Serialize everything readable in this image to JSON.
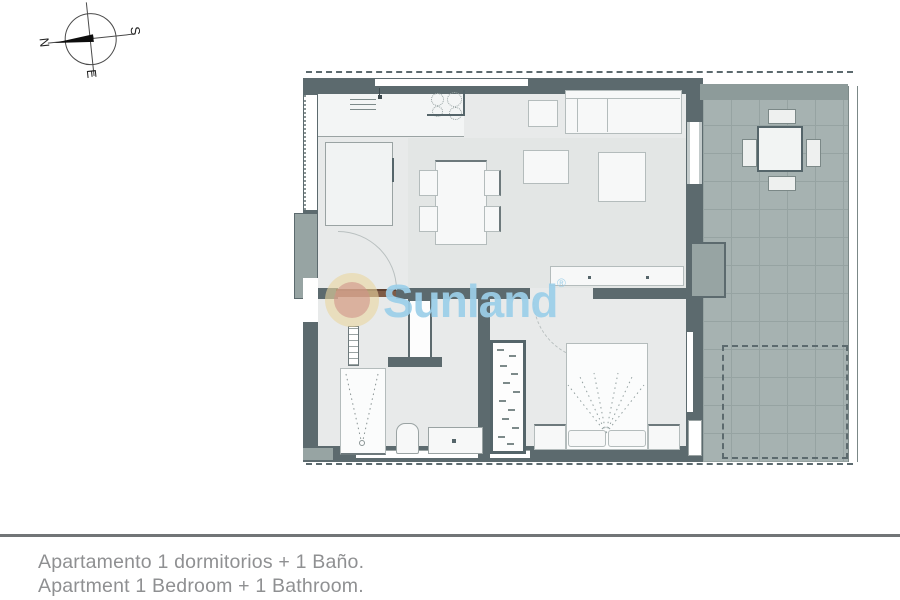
{
  "compass": {
    "north": "N",
    "south": "S",
    "east": "E"
  },
  "watermark": {
    "brand": "Sunland",
    "registered_mark": "®"
  },
  "caption": {
    "spanish": "Apartamento 1 dormitorios + 1 Baño.",
    "english": "Apartment 1 Bedroom + 1 Bathroom."
  },
  "plan_items": [
    "kitchen",
    "living-dining-room",
    "bathroom",
    "bedroom",
    "terrace"
  ],
  "colors": {
    "wall": "#5c6a6e",
    "wall-light": "#97a4a3",
    "floor": "#e8eaea",
    "floor-shade": "#e3e6e5",
    "terrace": "#a6b2b1",
    "terrace-line": "#96a3a2",
    "furn": "#f7f8f8",
    "furn-border": "#b4bcbc",
    "line-dark": "#6d797c",
    "accent-blue": "#9ccfe9",
    "sun-outer": "rgba(233,213,158,0.60)",
    "sun-inner": "rgba(209,146,136,0.60)",
    "text-gray": "#8f9092",
    "divider": "#717577",
    "door-brown": "#7e5b46",
    "arc": "#b9c0c0"
  }
}
